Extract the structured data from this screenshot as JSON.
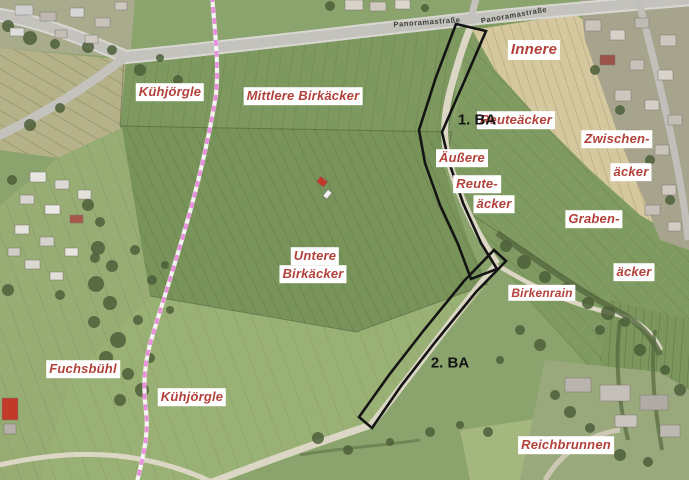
{
  "map": {
    "street_labels": [
      {
        "text": "Panoramastraße"
      },
      {
        "text": "Panoramastraße"
      }
    ],
    "field_labels": [
      {
        "id": "kuehjoergle-nord",
        "text": "Kühjörgle"
      },
      {
        "id": "mittlere-birkaecker",
        "text": "Mittlere Birkäcker"
      },
      {
        "id": "innere",
        "text": "Innere"
      },
      {
        "id": "reuteaecker",
        "text": "Reuteäcker"
      },
      {
        "id": "zwischen",
        "text": "Zwischen-"
      },
      {
        "id": "zwischen-aecker",
        "text": "äcker"
      },
      {
        "id": "aeussere",
        "text": "Äußere"
      },
      {
        "id": "reute",
        "text": "Reute-"
      },
      {
        "id": "reute-aecker",
        "text": "äcker"
      },
      {
        "id": "graben",
        "text": "Graben-"
      },
      {
        "id": "graben-aecker",
        "text": "äcker"
      },
      {
        "id": "birkenrain",
        "text": "Birkenrain"
      },
      {
        "id": "untere",
        "text": "Untere"
      },
      {
        "id": "untere-birkaecker",
        "text": "Birkäcker"
      },
      {
        "id": "fuchsbuehl",
        "text": "Fuchsbühl"
      },
      {
        "id": "kuehjoergle-sued",
        "text": "Kühjörgle"
      },
      {
        "id": "reichbrunnen",
        "text": "Reichbrunnen"
      }
    ],
    "construction_labels": [
      {
        "id": "ba1",
        "text": "1. BA"
      },
      {
        "id": "ba2",
        "text": "2. BA"
      }
    ],
    "colors": {
      "field_label_text": "#b2413a",
      "field_label_bg": "#ffffff",
      "construction_label_text": "#141414",
      "construction_outline": "#141414",
      "parcel_boundary_pink": "#e990dd",
      "farmland_green": "#8ba46d",
      "harvested_beige": "#d5c89e",
      "road_gray": "#c6c5c0"
    }
  }
}
